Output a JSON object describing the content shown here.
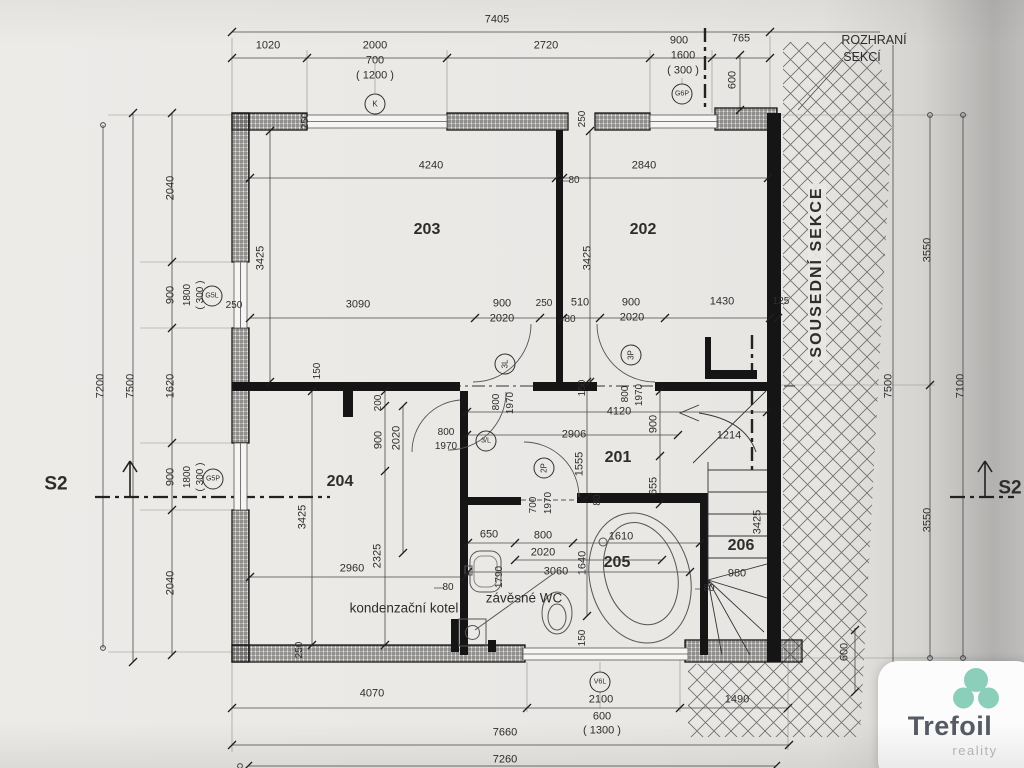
{
  "page": {
    "kind": "scanned floor plan drawing",
    "sheet_color": "#eae8e5",
    "ink_color": "#2d2d2d"
  },
  "logo": {
    "brand": "Trefoil",
    "subtitle": "reality",
    "clover_color": "#8bcfba"
  },
  "annotations": [
    {
      "t": "7405",
      "x": 497,
      "y": 20
    },
    {
      "t": "1020",
      "x": 268,
      "y": 46
    },
    {
      "t": "2000",
      "x": 375,
      "y": 46
    },
    {
      "t": "700",
      "x": 375,
      "y": 61
    },
    {
      "t": "( 1200 )",
      "x": 375,
      "y": 76
    },
    {
      "t": "2720",
      "x": 546,
      "y": 46
    },
    {
      "t": "900",
      "x": 679,
      "y": 41
    },
    {
      "t": "1600",
      "x": 683,
      "y": 56
    },
    {
      "t": "( 300 )",
      "x": 683,
      "y": 71
    },
    {
      "t": "765",
      "x": 741,
      "y": 39
    },
    {
      "t": "K",
      "x": 375,
      "y": 104,
      "k": "c",
      "fs": 8,
      "n": "window-ref-k"
    },
    {
      "t": "G6P",
      "x": 682,
      "y": 94,
      "k": "c",
      "fs": 7,
      "n": "window-ref-g6p"
    },
    {
      "t": "ROZHRANÍ",
      "x": 874,
      "y": 40,
      "fs": 12.5,
      "n": "section-boundary-label"
    },
    {
      "t": "SEKCÍ",
      "x": 862,
      "y": 57,
      "fs": 12.5,
      "n": "section-boundary-label"
    },
    {
      "t": "600",
      "x": 733,
      "y": 80,
      "r": -90
    },
    {
      "t": "2040",
      "x": 171,
      "y": 188,
      "r": -90
    },
    {
      "t": "900",
      "x": 171,
      "y": 295,
      "r": -90
    },
    {
      "t": "1800",
      "x": 188,
      "y": 295,
      "r": -90,
      "fs": 10
    },
    {
      "t": "( 300 )",
      "x": 201,
      "y": 295,
      "r": -90,
      "fs": 10
    },
    {
      "t": "1620",
      "x": 171,
      "y": 386,
      "r": -90
    },
    {
      "t": "900",
      "x": 171,
      "y": 477,
      "r": -90
    },
    {
      "t": "1800",
      "x": 188,
      "y": 477,
      "r": -90,
      "fs": 10
    },
    {
      "t": "( 300 )",
      "x": 201,
      "y": 477,
      "r": -90,
      "fs": 10
    },
    {
      "t": "2040",
      "x": 171,
      "y": 583,
      "r": -90
    },
    {
      "t": "7200",
      "x": 101,
      "y": 386,
      "r": -90
    },
    {
      "t": "7500",
      "x": 131,
      "y": 386,
      "r": -90
    },
    {
      "t": "G5L",
      "x": 212,
      "y": 296,
      "k": "c",
      "fs": 7,
      "n": "window-ref-g5l"
    },
    {
      "t": "G5P",
      "x": 213,
      "y": 479,
      "k": "c",
      "fs": 7,
      "n": "window-ref-g5p"
    },
    {
      "t": "250",
      "x": 234,
      "y": 306,
      "fs": 10
    },
    {
      "t": "S2",
      "x": 56,
      "y": 484,
      "fs": 19,
      "w": 1,
      "n": "section-mark-s2-left"
    },
    {
      "t": "S2",
      "x": 1010,
      "y": 488,
      "fs": 19,
      "w": 1,
      "n": "section-mark-s2-right"
    },
    {
      "t": "3550",
      "x": 928,
      "y": 250,
      "r": -90
    },
    {
      "t": "3550",
      "x": 928,
      "y": 520,
      "r": -90
    },
    {
      "t": "7500",
      "x": 889,
      "y": 386,
      "r": -90
    },
    {
      "t": "7100",
      "x": 961,
      "y": 386,
      "r": -90
    },
    {
      "t": "600",
      "x": 845,
      "y": 652,
      "r": -90
    },
    {
      "t": "4070",
      "x": 372,
      "y": 694
    },
    {
      "t": "2100",
      "x": 601,
      "y": 700
    },
    {
      "t": "600",
      "x": 602,
      "y": 717
    },
    {
      "t": "( 1300 )",
      "x": 602,
      "y": 731
    },
    {
      "t": "1490",
      "x": 737,
      "y": 700
    },
    {
      "t": "V6L",
      "x": 600,
      "y": 682,
      "k": "c",
      "fs": 7,
      "n": "window-ref-v6l"
    },
    {
      "t": "7660",
      "x": 505,
      "y": 733
    },
    {
      "t": "7260",
      "x": 505,
      "y": 760
    },
    {
      "t": "4240",
      "x": 431,
      "y": 166
    },
    {
      "t": "2840",
      "x": 644,
      "y": 166
    },
    {
      "t": "203",
      "x": 427,
      "y": 230,
      "fs": 16,
      "w": 1,
      "n": "room-number-203"
    },
    {
      "t": "202",
      "x": 643,
      "y": 230,
      "fs": 16,
      "w": 1,
      "n": "room-number-202"
    },
    {
      "t": "3425",
      "x": 261,
      "y": 258,
      "r": -90
    },
    {
      "t": "3425",
      "x": 588,
      "y": 258,
      "r": -90
    },
    {
      "t": "80",
      "x": 574,
      "y": 181,
      "fs": 10
    },
    {
      "t": "250",
      "x": 306,
      "y": 121,
      "r": -90,
      "fs": 10
    },
    {
      "t": "250",
      "x": 583,
      "y": 119,
      "r": -90,
      "fs": 10
    },
    {
      "t": "3090",
      "x": 358,
      "y": 305
    },
    {
      "t": "900",
      "x": 502,
      "y": 304
    },
    {
      "t": "250",
      "x": 544,
      "y": 304,
      "fs": 10
    },
    {
      "t": "510",
      "x": 580,
      "y": 303
    },
    {
      "t": "900",
      "x": 631,
      "y": 303
    },
    {
      "t": "1430",
      "x": 722,
      "y": 302
    },
    {
      "t": "125",
      "x": 781,
      "y": 302,
      "fs": 10
    },
    {
      "t": "2020",
      "x": 502,
      "y": 319
    },
    {
      "t": "80",
      "x": 570,
      "y": 320,
      "fs": 10
    },
    {
      "t": "2020",
      "x": 632,
      "y": 318
    },
    {
      "t": "3L",
      "x": 505,
      "y": 364,
      "k": "c",
      "r": -90,
      "fs": 8,
      "n": "door-ref-3l"
    },
    {
      "t": "3P",
      "x": 631,
      "y": 355,
      "k": "c",
      "r": -90,
      "fs": 8,
      "n": "door-ref-3p"
    },
    {
      "t": "150",
      "x": 318,
      "y": 371,
      "r": -90,
      "fs": 10
    },
    {
      "t": "200",
      "x": 379,
      "y": 403,
      "r": -90,
      "fs": 10
    },
    {
      "t": "900",
      "x": 379,
      "y": 440,
      "r": -90
    },
    {
      "t": "2020",
      "x": 397,
      "y": 438,
      "r": -90
    },
    {
      "t": "800",
      "x": 446,
      "y": 433,
      "fs": 10
    },
    {
      "t": "1970",
      "x": 446,
      "y": 447,
      "fs": 10
    },
    {
      "t": "3/L",
      "x": 486,
      "y": 441,
      "k": "c",
      "fs": 7,
      "n": "door-ref-3l-2"
    },
    {
      "t": "800",
      "x": 497,
      "y": 402,
      "r": -90,
      "fs": 10
    },
    {
      "t": "1970",
      "x": 511,
      "y": 403,
      "r": -90,
      "fs": 10
    },
    {
      "t": "150",
      "x": 583,
      "y": 388,
      "r": -90,
      "fs": 10
    },
    {
      "t": "800",
      "x": 626,
      "y": 394,
      "r": -90,
      "fs": 10
    },
    {
      "t": "1970",
      "x": 640,
      "y": 395,
      "r": -90,
      "fs": 10
    },
    {
      "t": "4120",
      "x": 619,
      "y": 412
    },
    {
      "t": "2906",
      "x": 574,
      "y": 435
    },
    {
      "t": "900",
      "x": 654,
      "y": 424,
      "r": -90
    },
    {
      "t": "201",
      "x": 618,
      "y": 458,
      "fs": 16,
      "w": 1,
      "n": "room-number-201"
    },
    {
      "t": "1555",
      "x": 580,
      "y": 464,
      "r": -90
    },
    {
      "t": "655",
      "x": 654,
      "y": 486,
      "r": -90
    },
    {
      "t": "80",
      "x": 598,
      "y": 500,
      "r": -90,
      "fs": 10
    },
    {
      "t": "1214",
      "x": 729,
      "y": 436
    },
    {
      "t": "2P",
      "x": 544,
      "y": 468,
      "k": "c",
      "r": -90,
      "fs": 8,
      "n": "door-ref-2p"
    },
    {
      "t": "700",
      "x": 534,
      "y": 505,
      "r": -90,
      "fs": 10
    },
    {
      "t": "1970",
      "x": 549,
      "y": 503,
      "r": -90,
      "fs": 10
    },
    {
      "t": "204",
      "x": 340,
      "y": 482,
      "fs": 16,
      "w": 1,
      "n": "room-number-204"
    },
    {
      "t": "3425",
      "x": 303,
      "y": 517,
      "r": -90
    },
    {
      "t": "2960",
      "x": 352,
      "y": 569
    },
    {
      "t": "2325",
      "x": 378,
      "y": 556,
      "r": -90
    },
    {
      "t": "kondenzační kotel",
      "x": 404,
      "y": 608,
      "fs": 13.5,
      "n": "boiler-label"
    },
    {
      "t": "80",
      "x": 448,
      "y": 588,
      "fs": 10
    },
    {
      "t": "250",
      "x": 300,
      "y": 650,
      "r": -90,
      "fs": 10
    },
    {
      "t": "650",
      "x": 489,
      "y": 535
    },
    {
      "t": "800",
      "x": 543,
      "y": 536
    },
    {
      "t": "2020",
      "x": 543,
      "y": 553
    },
    {
      "t": "1610",
      "x": 621,
      "y": 537
    },
    {
      "t": "1640",
      "x": 583,
      "y": 563,
      "r": -90
    },
    {
      "t": "3060",
      "x": 556,
      "y": 572
    },
    {
      "t": "205",
      "x": 617,
      "y": 563,
      "fs": 16,
      "w": 1,
      "n": "room-number-205"
    },
    {
      "t": "1790",
      "x": 500,
      "y": 577,
      "r": -90,
      "fs": 10
    },
    {
      "t": "závěsné WC",
      "x": 524,
      "y": 598,
      "fs": 13.5,
      "n": "wc-label"
    },
    {
      "t": "150",
      "x": 583,
      "y": 638,
      "r": -90,
      "fs": 10
    },
    {
      "t": "80",
      "x": 709,
      "y": 589,
      "fs": 10
    },
    {
      "t": "206",
      "x": 741,
      "y": 546,
      "fs": 16,
      "w": 1,
      "n": "room-number-206"
    },
    {
      "t": "3425",
      "x": 758,
      "y": 522,
      "r": -90
    },
    {
      "t": "980",
      "x": 737,
      "y": 574
    },
    {
      "t": "SOUSEDNÍ SEKCE",
      "x": 817,
      "y": 272,
      "r": -90,
      "fs": 16,
      "w": 1,
      "ls": 2,
      "bg": 1,
      "n": "adjacent-section-label"
    }
  ]
}
